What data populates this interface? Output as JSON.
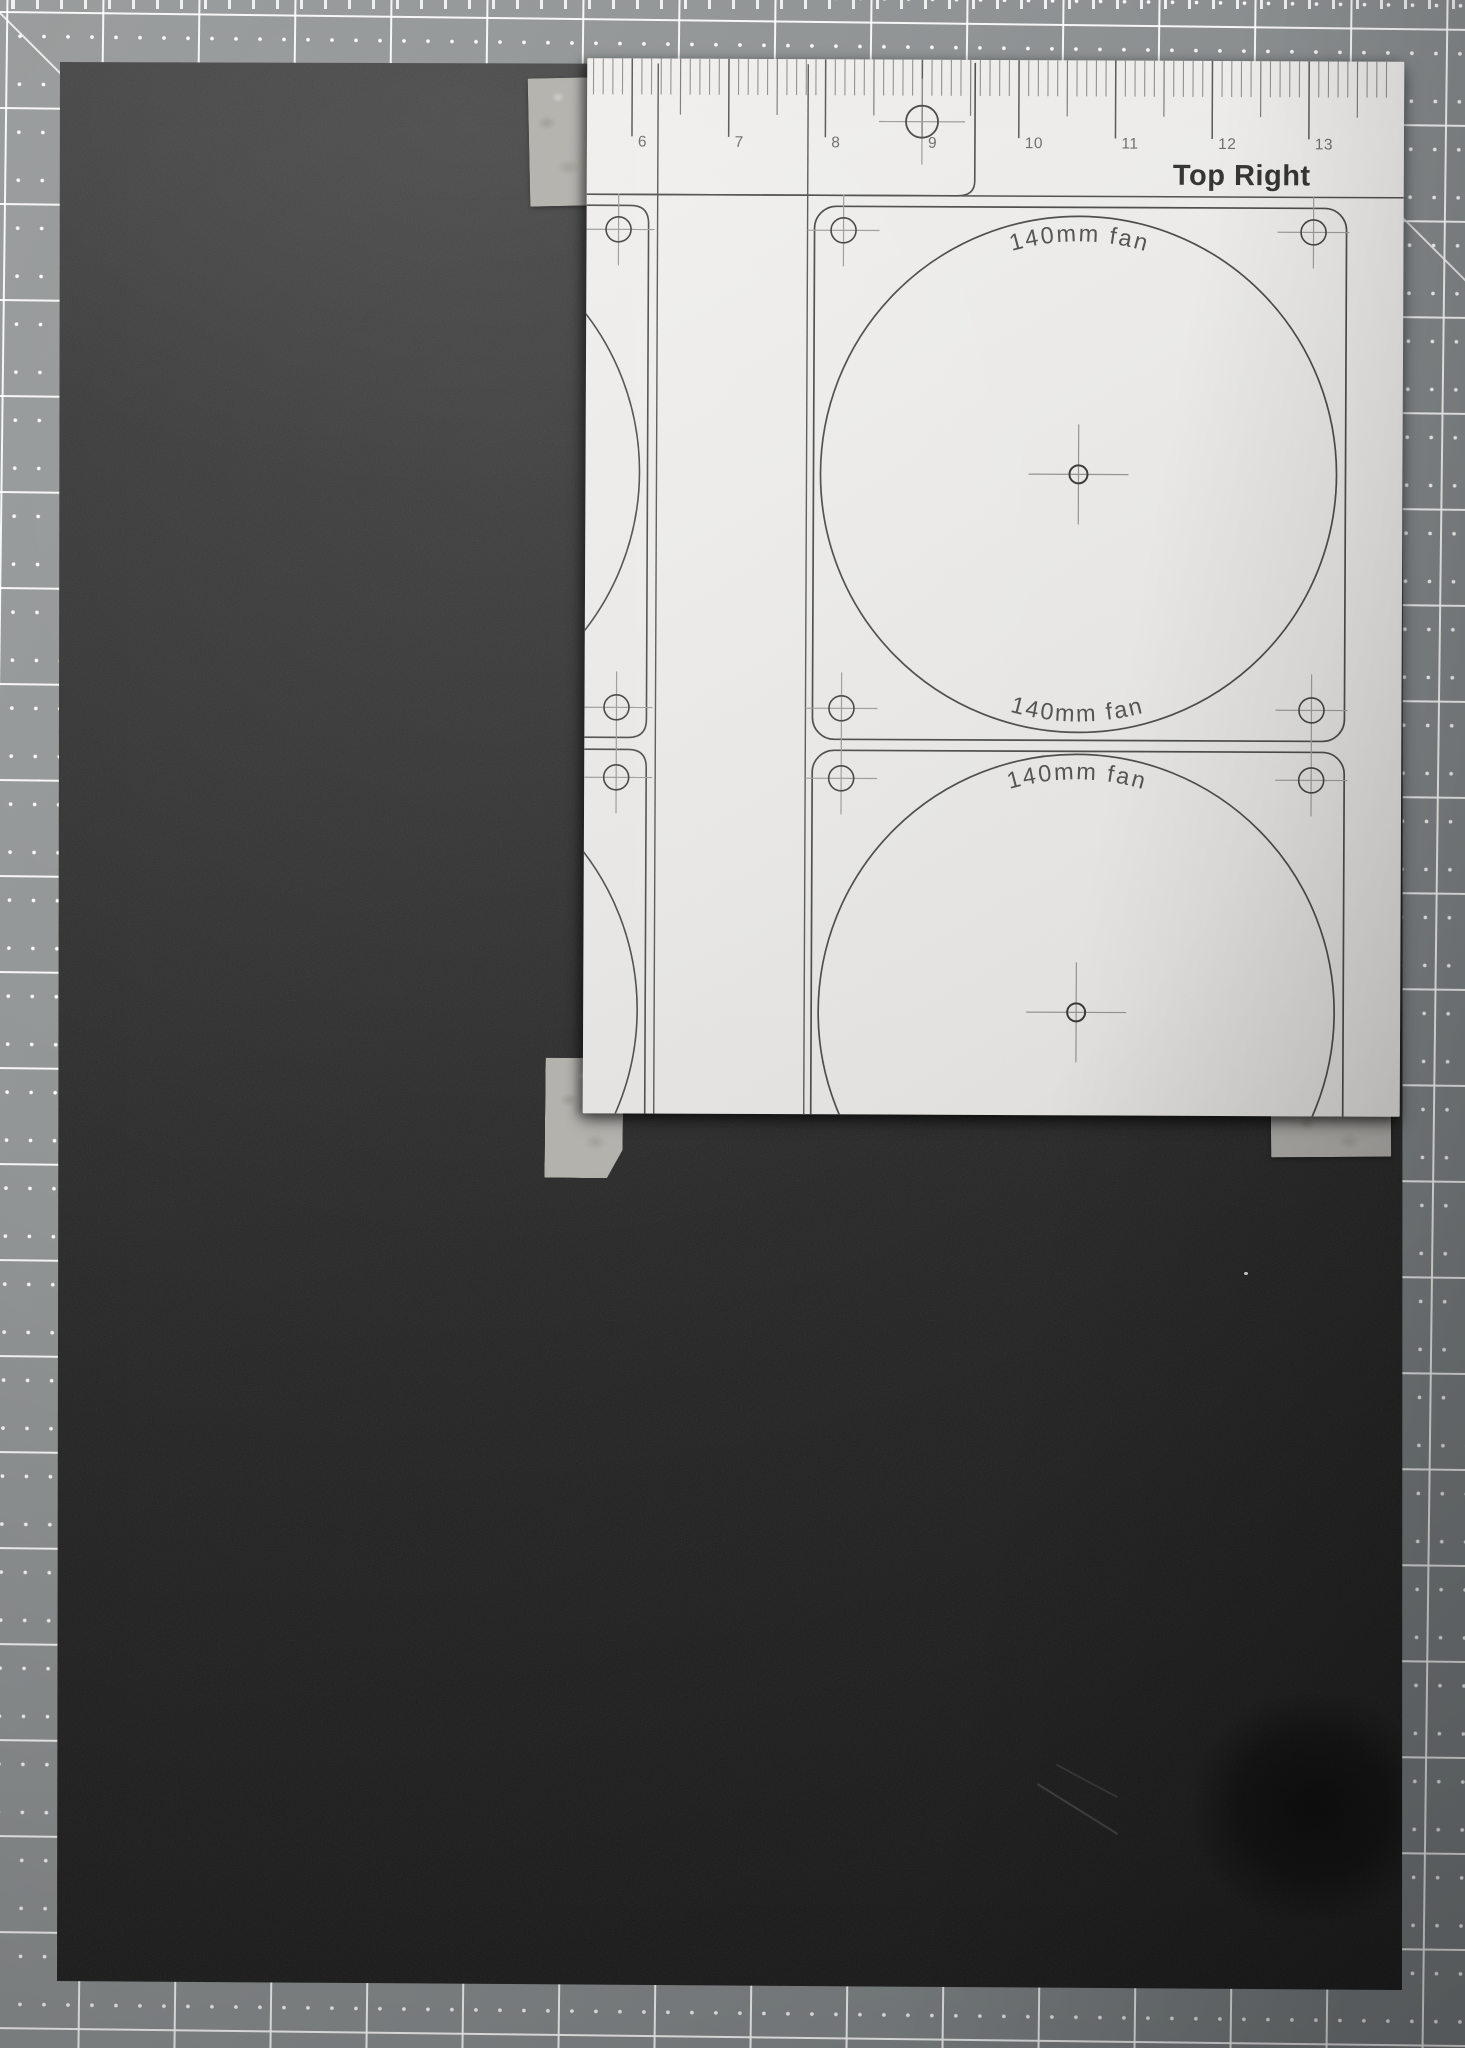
{
  "corner_label": "Top Right",
  "fan_label": "140mm fan",
  "ruler": {
    "numbers": [
      "6",
      "7",
      "8",
      "9",
      "10",
      "11",
      "12",
      "13"
    ]
  },
  "marks": {
    "screw_hole": "circle-crosshair",
    "fan_center": "circle-crosshair",
    "registration": "circle-crosshair"
  },
  "colors": {
    "mat": "#8f9394",
    "mat_grid_line": "#ffffff",
    "foam_board": "#1e1e1e",
    "paper": "#eae9e7",
    "template_line": "#474747",
    "crosshair_arm": "#9a9a9a",
    "tape": "#b3b1ac",
    "label_text": "#4d4d4d"
  }
}
